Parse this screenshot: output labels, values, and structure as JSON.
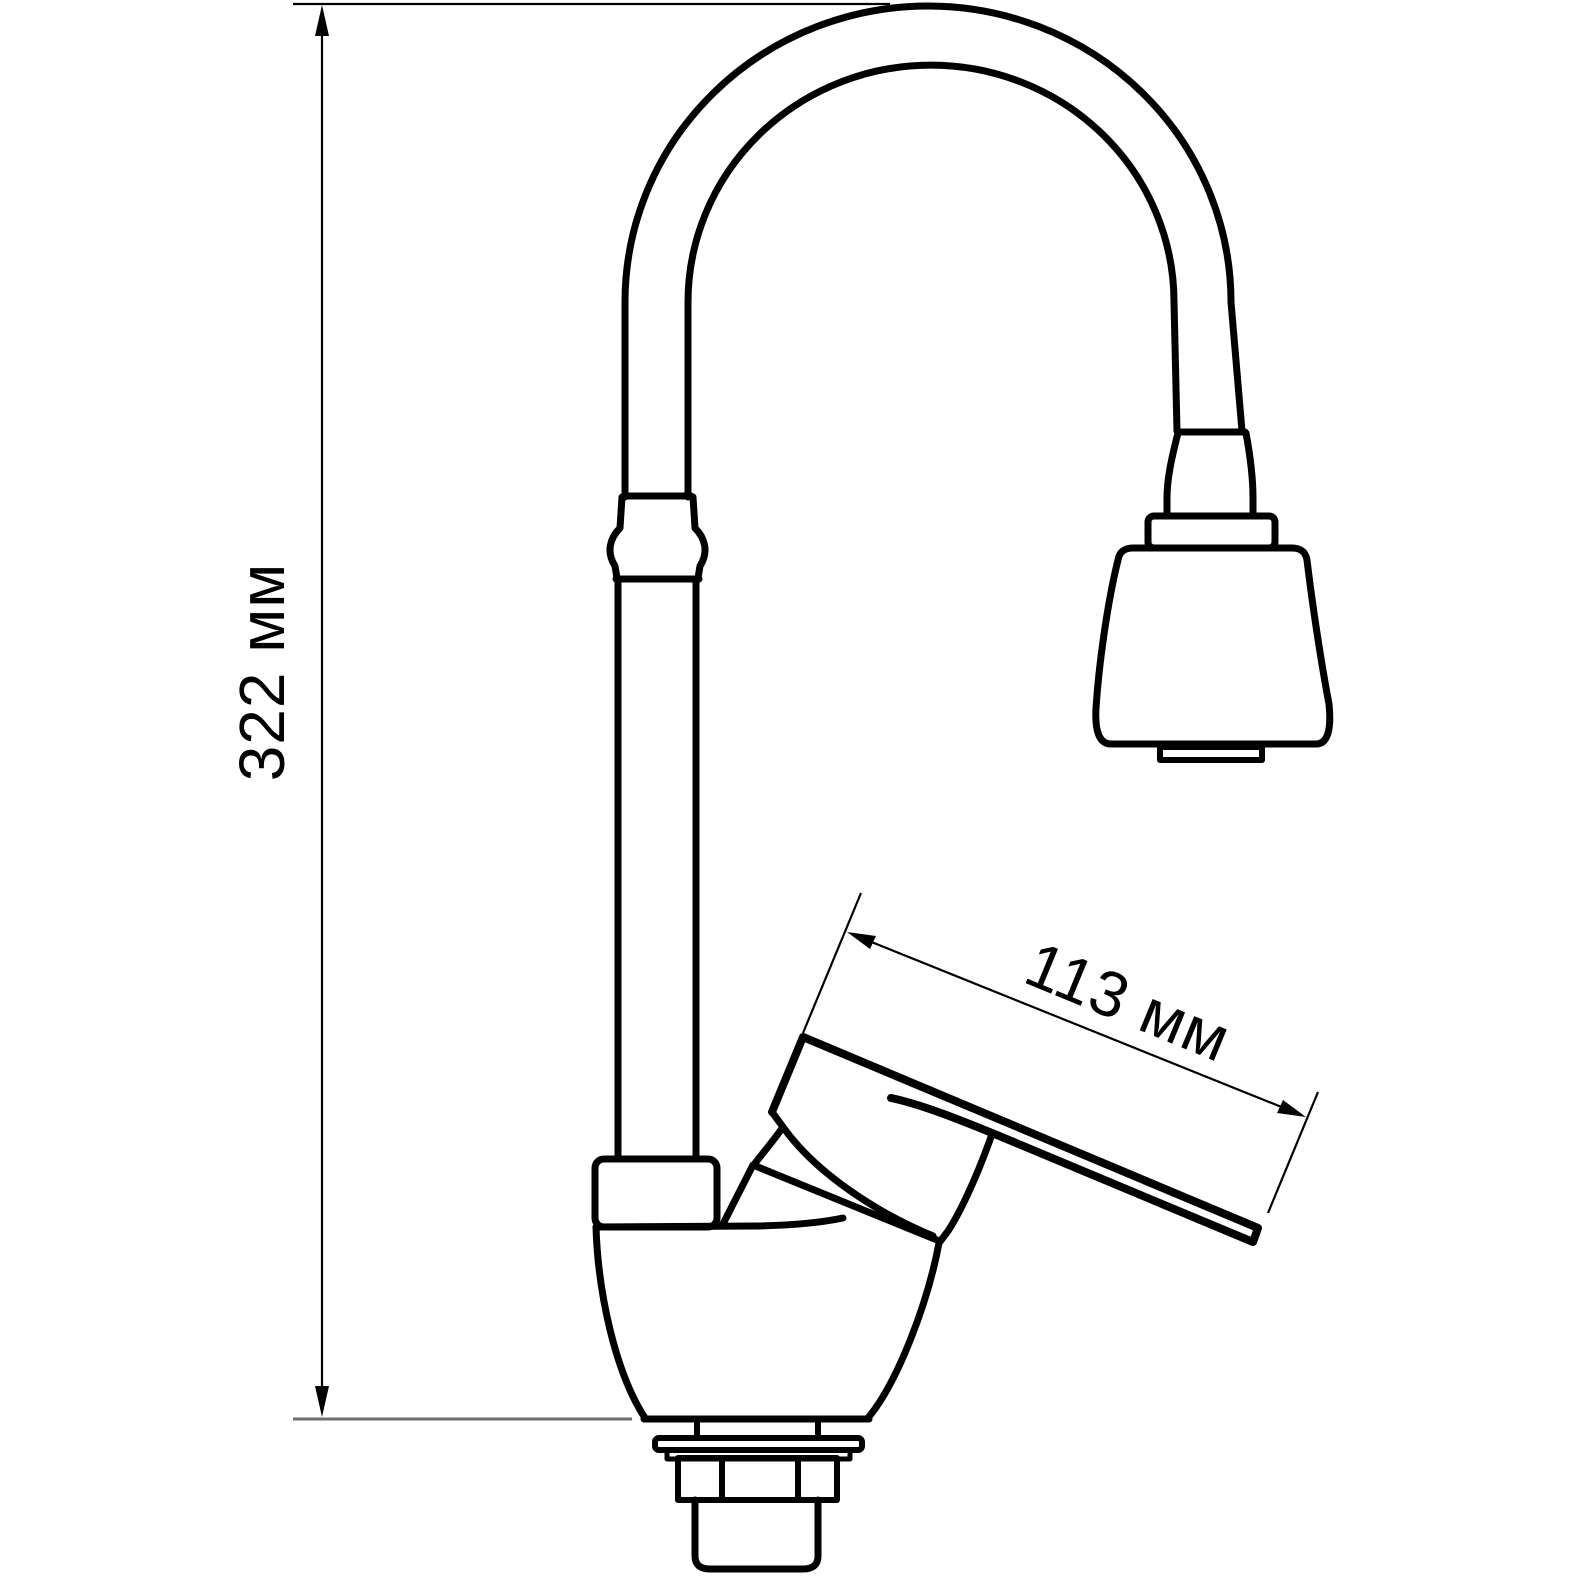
{
  "drawing": {
    "subject": "kitchen-faucet-technical-drawing",
    "view": "side-elevation",
    "dimensions": {
      "height": {
        "value": "322",
        "unit": "мм",
        "label": "322 мм"
      },
      "reach": {
        "value": "113",
        "unit": "мм",
        "label": "113 мм"
      }
    },
    "colors": {
      "ink": "#000000",
      "muted_line": "#6e6e6e",
      "background": "#ffffff"
    }
  }
}
